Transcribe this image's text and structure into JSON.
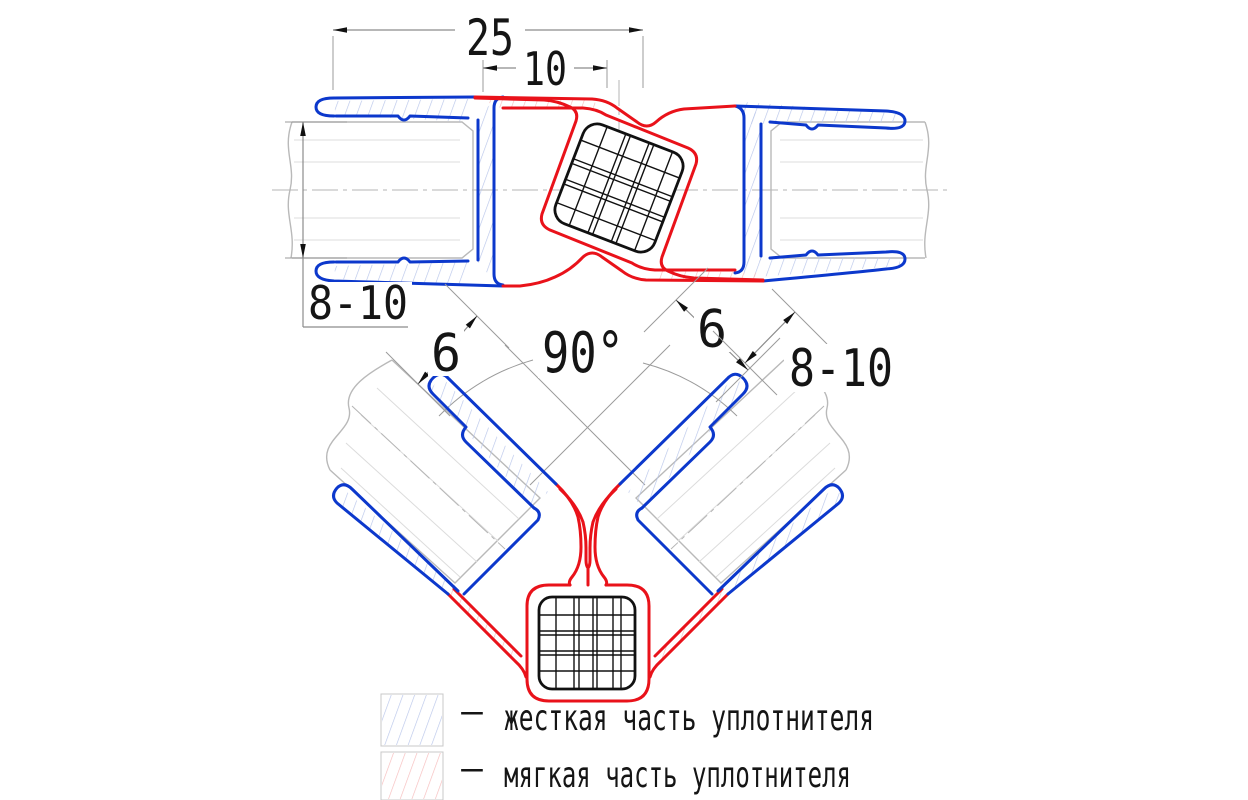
{
  "drawing": {
    "top_view": {
      "dim_total_width": "25",
      "dim_magnet_pocket": "10",
      "dim_glass_thickness": "8-10"
    },
    "corner_view": {
      "dim_left_lip": "6",
      "dim_angle": "90°",
      "dim_right_lip": "6",
      "dim_glass_thickness": "8-10"
    },
    "legend": {
      "rows": [
        {
          "bullet": "–",
          "label": "жесткая часть уплотнителя"
        },
        {
          "bullet": "–",
          "label": "мягкая часть уплотнителя"
        }
      ]
    },
    "colors": {
      "rigid": "#0c38cc",
      "soft": "#e9121a",
      "hatch_rigid": "#b9c6ea",
      "hatch_soft": "#f6bcbc",
      "glass": "#b9b9b9",
      "construction": "#9b9b9b",
      "magnet": "#111111"
    }
  }
}
